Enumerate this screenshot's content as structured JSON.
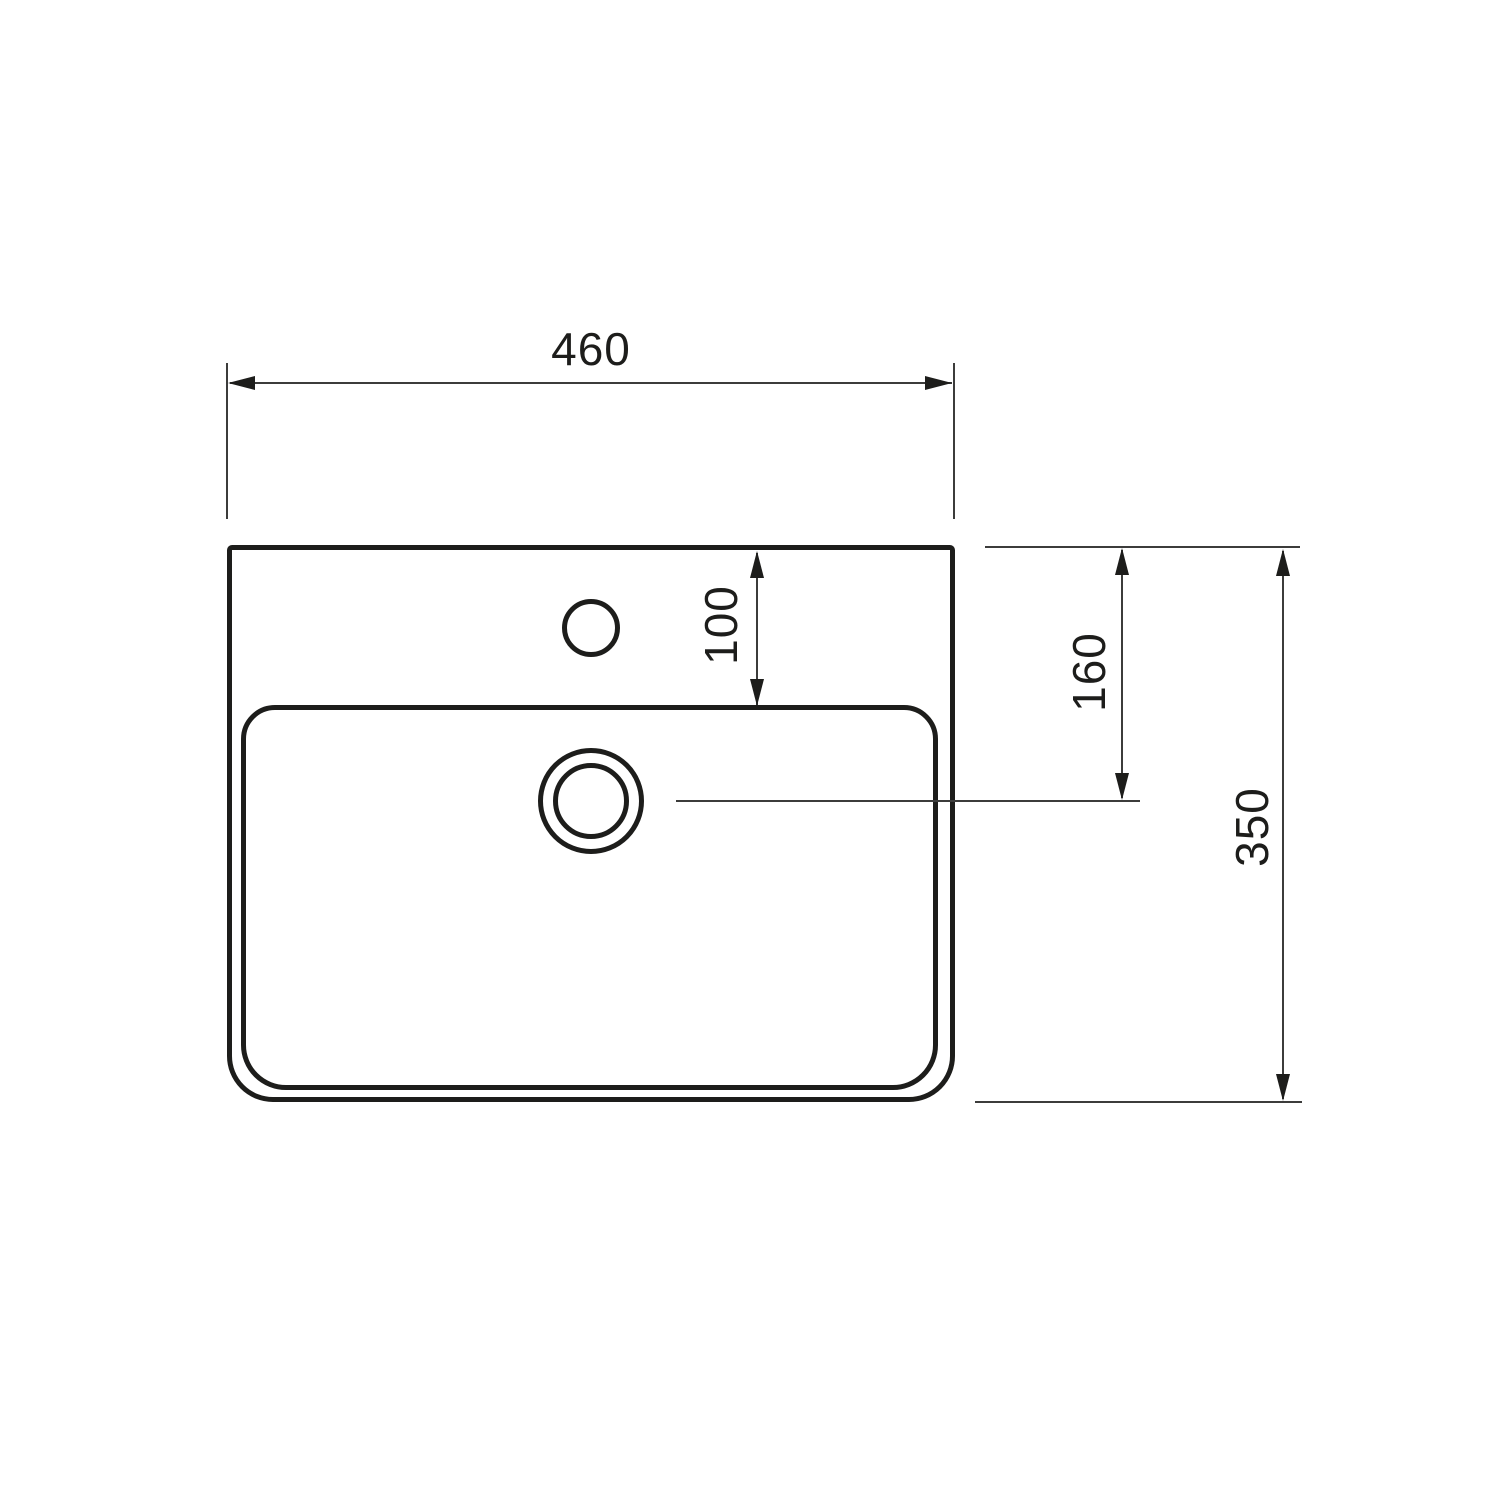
{
  "drawing": {
    "subject": "wall-hung washbasin, top view dimension drawing",
    "colors": {
      "line": "#1d1d1b",
      "thin_line": "#3c3c3b",
      "background": "#ffffff"
    },
    "dimensions": {
      "overall_width": {
        "label": "460",
        "unit": "mm",
        "orientation": "horizontal"
      },
      "rim_to_basin": {
        "label": "100",
        "unit": "mm",
        "orientation": "vertical"
      },
      "rim_to_drain": {
        "label": "160",
        "unit": "mm",
        "orientation": "vertical"
      },
      "overall_depth": {
        "label": "350",
        "unit": "mm",
        "orientation": "vertical"
      }
    },
    "features": [
      "sink-outline",
      "basin-rim",
      "faucet-hole",
      "drain-hole"
    ]
  }
}
